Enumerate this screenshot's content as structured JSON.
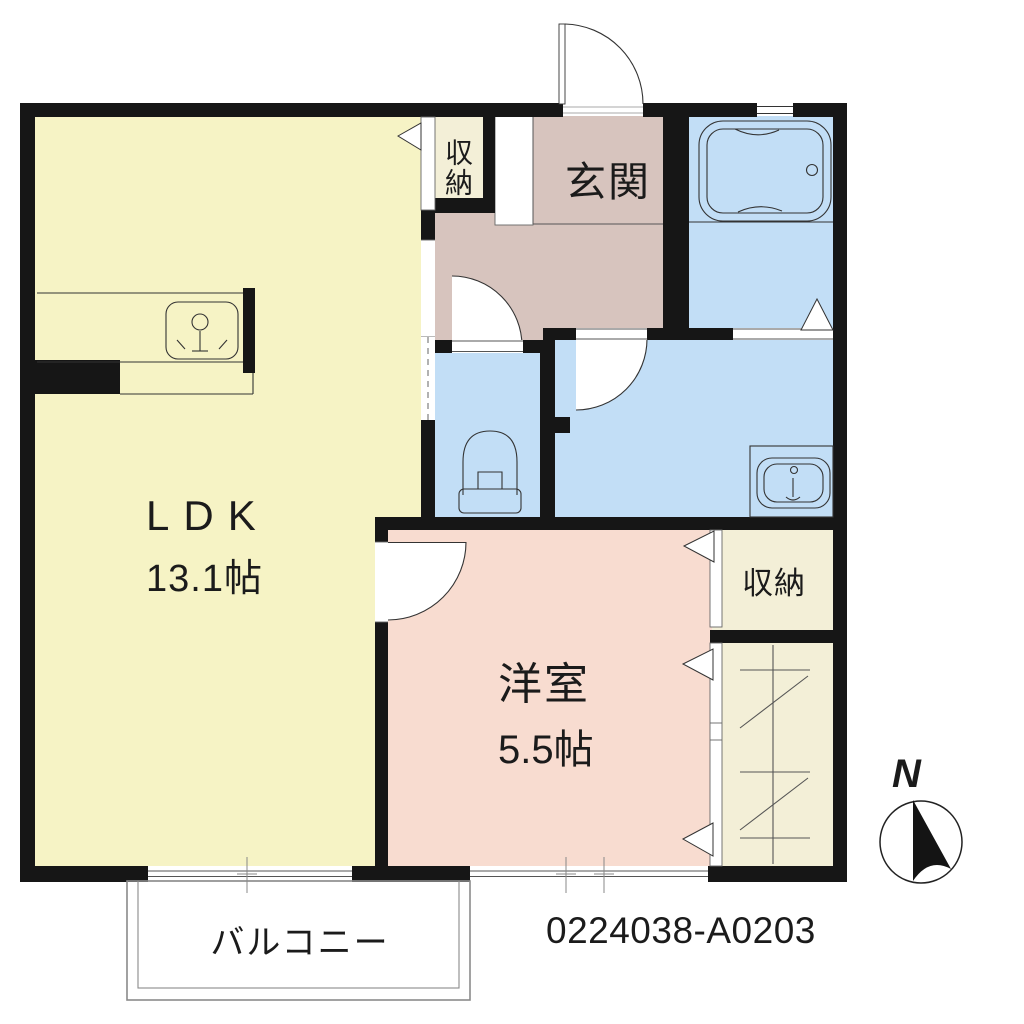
{
  "floorplan": {
    "property_code": "0224038-A0203",
    "compass": {
      "label": "N"
    },
    "rooms": {
      "ldk": {
        "name": "LDK",
        "area": "13.1帖"
      },
      "western_room": {
        "name": "洋室",
        "area": "5.5帖"
      },
      "entrance": {
        "name": "玄関"
      },
      "storage_entrance": {
        "name": "収納"
      },
      "storage_bedroom": {
        "name": "収納"
      },
      "balcony": {
        "name": "バルコニー"
      }
    },
    "colors": {
      "wall": "#161616",
      "ldk-fill": "#f6f3c5",
      "storage-fill": "#f3efd7",
      "hall-fill": "#d7c4be",
      "western-fill": "#f8dcd0",
      "wet-fill": "#c2def6",
      "balcony-line": "#8a8a8a"
    }
  }
}
